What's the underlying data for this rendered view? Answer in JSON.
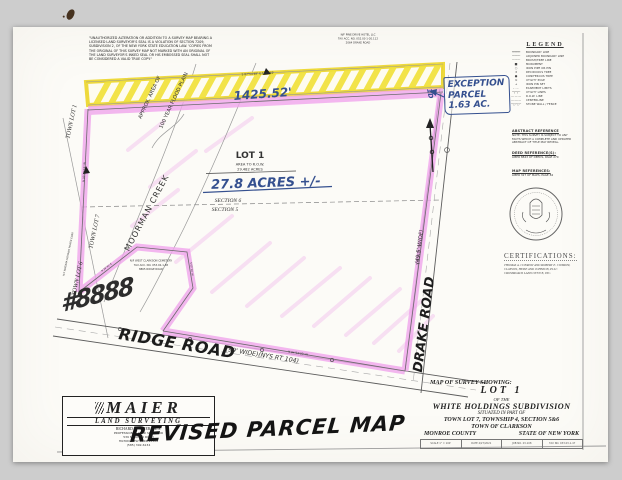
{
  "disclaimer": {
    "lines": [
      "\"UNAUTHORIZED ALTERATION OR ADDITION TO A SURVEY MAP BEARING A",
      "LICENSED LAND SURVEYOR'S SEAL IS A VIOLATION OF SECTION 7209,",
      "SUBDIVISION 2, OF THE NEW YORK STATE EDUCATION LAW. 'COPIES FROM",
      "THE ORIGINAL OF THIS SURVEY MAP NOT MARKED WITH AN ORIGINAL OF",
      "THE LAND SURVEYOR'S INKED SEAL OR HIS EMBOSSED SEAL SHALL NOT",
      "BE CONSIDERED A VALID TRUE COPY.\""
    ]
  },
  "map": {
    "north_adjoiner": {
      "line1": "N/F PINE DRIVE HOTEL LLC",
      "line2": "TAX ACC. NO. 052.03-1-20.112",
      "line3": "2064 DRAKE ROAD"
    },
    "bearings": {
      "north": "S 87°54'48\" E   1425.52'",
      "west": "N 02°45'15\" W",
      "south": "N 84°52'30\" W",
      "east": "S 06°15'00\" W",
      "notch_a": "N 38°40' E",
      "notch_b": "S 05°10' W"
    },
    "lot": {
      "title": "LOT 1",
      "area_label": "AREA TO R.O.W.",
      "area_value": "29.482 ACRES"
    },
    "sections": {
      "upper": "SECTION 6",
      "lower": "SECTION 5"
    },
    "creek_label": "MOORMAN CREEK",
    "floodplain": {
      "line1": "APPROX. AREA OF",
      "line2": "100 YEAR FLOOD PLAIN"
    },
    "town_lots": {
      "lot1": "TOWN LOT 1",
      "lot7": "TOWN LOT 7",
      "lot6": "TOWN LOT 6"
    },
    "west_adjoiner": "N/F NIAGARA MOHAWK POWER CORP.",
    "cemetery": {
      "line1": "N/F WEST CLARKSON CEMETERY",
      "line2": "TAX ACC. NO. 053.02-1-38",
      "line3": "8865 RIDGE ROAD"
    },
    "roads": {
      "ridge": "RIDGE ROAD",
      "ridge_detail": "(99' WIDE)(NYS RT 104)",
      "drake": "DRAKE ROAD",
      "drake_detail": "(49.5' WIDE)"
    },
    "handwritten": {
      "length": "1425.52'",
      "acres": "27.8 ACRES +/-",
      "parcel_scribble": "#8888",
      "revision": "REVISED PARCEL MAP",
      "exception_line1": "EXCEPTION",
      "exception_line2": "PARCEL",
      "exception_line3": "1.63 AC.",
      "exception_tag": "1D"
    }
  },
  "legend": {
    "title": "LEGEND",
    "items": [
      {
        "glyph": "━━━━━",
        "label": "BOUNDARY LINE"
      },
      {
        "glyph": "─────",
        "label": "ADJOINER BOUNDARY LINE"
      },
      {
        "glyph": "┄┄┄┄┄",
        "label": "BRUSH/TREE LINE"
      },
      {
        "glyph": "■",
        "label": "MONUMENT"
      },
      {
        "glyph": "○",
        "label": "IRON PIPE OR PIN"
      },
      {
        "glyph": "✶",
        "label": "DECIDUOUS TREE"
      },
      {
        "glyph": "●",
        "label": "CONIFEROUS TREE"
      },
      {
        "glyph": "⊙",
        "label": "UTILITY POLE"
      },
      {
        "glyph": "+",
        "label": "IRON PIN SET"
      },
      {
        "glyph": "– · – ·",
        "label": "EASEMENT LIMITS"
      },
      {
        "glyph": "─┬─┬─",
        "label": "UTILITY LINES"
      },
      {
        "glyph": "— — —",
        "label": "R.O.W. LINE"
      },
      {
        "glyph": "—·—·—",
        "label": "CENTERLINE"
      },
      {
        "glyph": "─○─○─",
        "label": "STONE WALL / FENCE"
      }
    ]
  },
  "references": {
    "abstract_title": "ABSTRACT REFERENCE",
    "abstract_lines": [
      "NOTE: THIS SURVEY IS SUBJECT TO ANY",
      "FACTS WHICH A COMPLETE AND UPDATED",
      "ABSTRACT OF TITLE MAY REVEAL."
    ],
    "deed_title": "DEED REFERENCE(S):",
    "deed_value": "LIBER 8843 OF DEEDS, PAGE 270",
    "map_title": "MAP REFERENCES:",
    "map_value": "LIBER 327 OF MAPS, PAGE 84"
  },
  "certifications": {
    "title": "CERTIFICATIONS:",
    "lines": [
      "THOMAS A. CONROW AND ROBERT E. CONROW,",
      "CLAYSON, HEISE AND JOHNSON, PLLC",
      "CROSSROADS LAND OFFICE, INC."
    ]
  },
  "title_block": {
    "heading": "MAP OF SURVEY SHOWING:",
    "lot": "LOT 1",
    "of_the": "OF THE",
    "subdivision": "WHITE HOLDINGS SUBDIVISION",
    "situated": "SITUATED IN PART OF",
    "township": "TOWN LOT 7, TOWNSHIP 4, SECTION 5&6",
    "town": "TOWN OF CLARKSON",
    "county": "MONROE COUNTY",
    "state": "STATE OF NEW YORK",
    "stamps": [
      "SCALE 1\" = 100'",
      "DATE 4/27/2021",
      "JOB NO. 23-108",
      "TAX NO. 033.03-1-47"
    ]
  },
  "surveyor": {
    "name": "MAIER",
    "division": "LAND  SURVEYING",
    "principal": "RICHARD E. MAIER, P.L.S.",
    "title": "PROFESSIONAL LAND SURVEYOR",
    "address1": "539 MANITOU ROAD",
    "address2": "HILTON, NEW YORK 14468",
    "phone": "(585) 392-6134"
  },
  "colors": {
    "highlight_yellow": "#f1e138",
    "highlight_pink": "#f0a5ec",
    "ink_blue": "#35508f",
    "linework": "#6b6b6b"
  }
}
